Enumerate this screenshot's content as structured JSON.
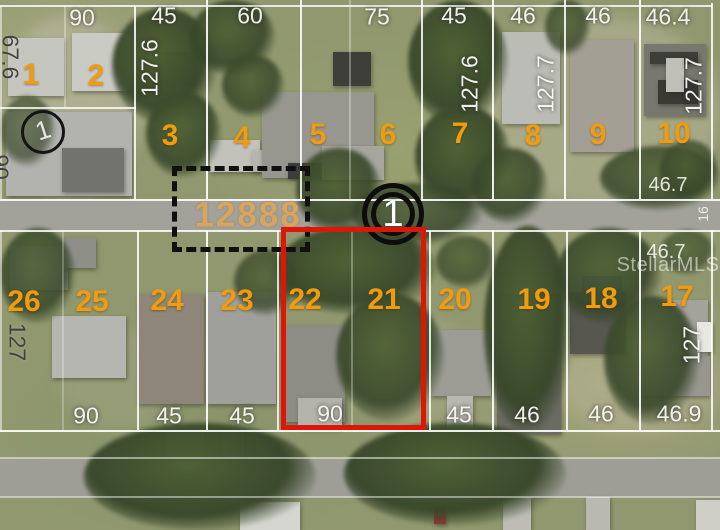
{
  "watermark": "StellarMLS",
  "annotations": {
    "address_number": "12888",
    "road_marker_label": "1",
    "roof_marker_label": "1"
  },
  "lot_numbers": {
    "top": [
      "1",
      "2",
      "3",
      "4",
      "5",
      "6",
      "7",
      "8",
      "9",
      "10"
    ],
    "bottom": [
      "26",
      "25",
      "24",
      "23",
      "22",
      "21",
      "20",
      "19",
      "18",
      "17"
    ]
  },
  "dimensions": {
    "top_edge": [
      "90",
      "45",
      "60",
      "75",
      "45",
      "46",
      "46",
      "46.4"
    ],
    "top_depths": [
      "67.6",
      "127.6",
      "127.6",
      "127.7",
      "127.7"
    ],
    "left_partial": "90",
    "right_mid": [
      "46.7",
      "16",
      "46.7"
    ],
    "bottom_edge": [
      "90",
      "45",
      "45",
      "90",
      "45",
      "46",
      "46",
      "46.9"
    ],
    "bottom_depths": [
      "127",
      "127"
    ]
  },
  "colors": {
    "lot_number": "#f09c10",
    "highlight_box": "#df1506",
    "address_number": "#dba65e",
    "parcel_line": "#ffffff"
  }
}
